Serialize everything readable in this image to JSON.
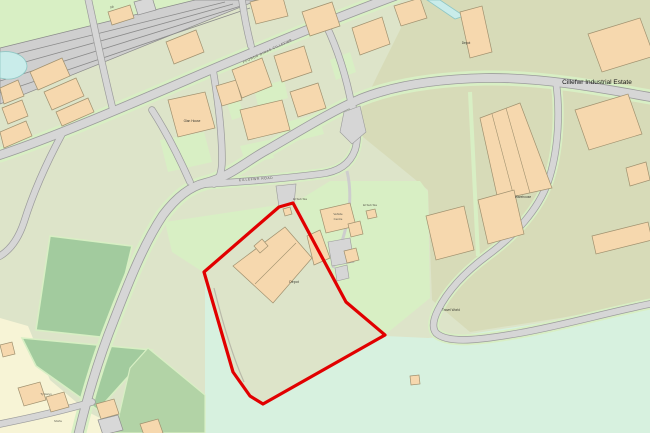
{
  "map": {
    "labels": {
      "estate": "Cillefwr Industrial Estate",
      "depot": "Depot",
      "depot_2": "Depot",
      "warehouse": "Warehouse",
      "el_sub_sta": "El Sub Sta",
      "el_sub_sta_2": "El Sub Sta",
      "glan_house": "Glan House",
      "vehicle_centre_1": "Vehicle",
      "vehicle_centre_2": "Centre",
      "travel_world": "Travel World",
      "road_name_main": "FFORDD DINAS CILLEFWR",
      "road_name_estate": "CILLEFWR ROAD",
      "signal_box": "SB",
      "house_1": "Ty Gwyn",
      "house_2": "Morfa"
    },
    "palette": {
      "base": "#dde4c9",
      "light-green": "#d8efc4",
      "mint": "#d7f1df",
      "olive": "#d7dbb8",
      "field-dark": "#a2cb9e",
      "field-mid": "#b2d3a6",
      "cream": "#f7f4d6",
      "building": "#f6d8ae",
      "building-outline": "#a0916f",
      "building-gray": "#d8d8d8",
      "road-fill": "#d6d6d6",
      "road-casing": "#9b9b9b",
      "railway": "#cfcfcf",
      "water": "#c9ecea",
      "water-outline": "#8fc7c4",
      "boundary-red": "#e10000",
      "label": "#3a3a32"
    }
  }
}
